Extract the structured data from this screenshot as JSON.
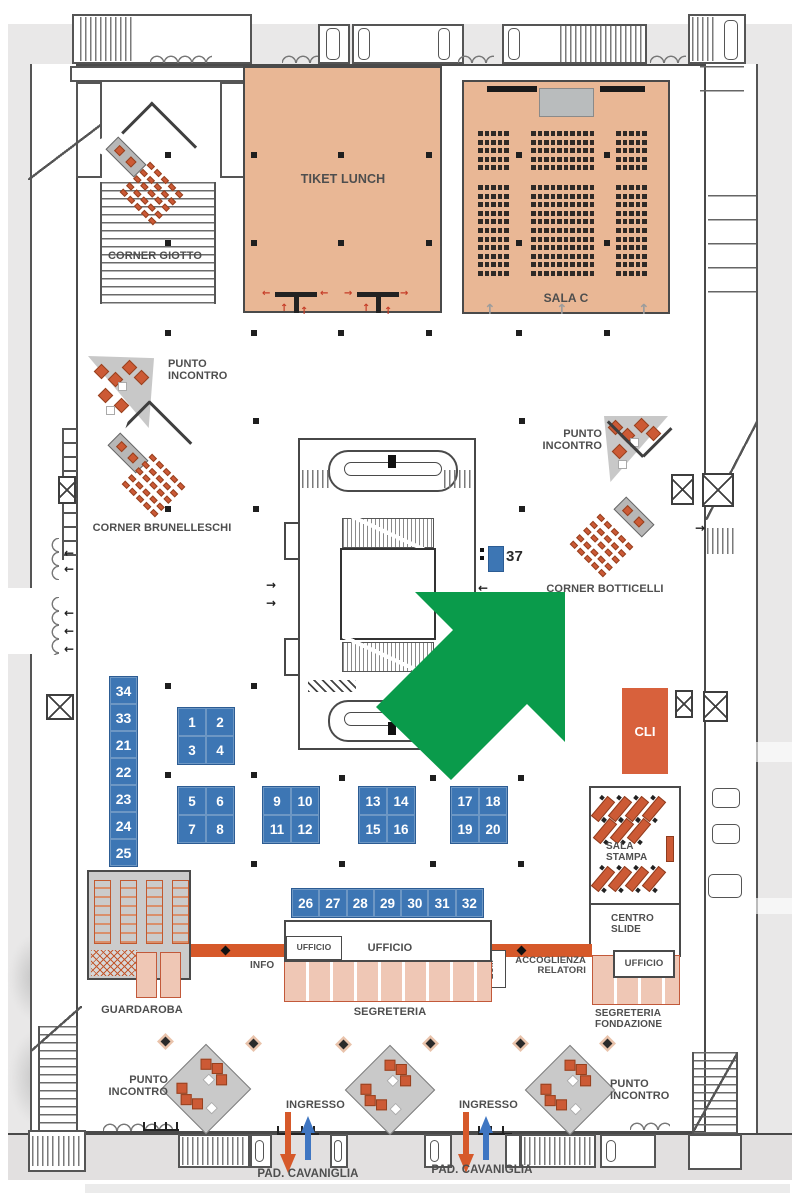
{
  "rooms": {
    "tiket_lunch": "TIKET LUNCH",
    "sala_c": "SALA C",
    "corner_giotto": "CORNER GIOTTO",
    "corner_brunelleschi": "CORNER BRUNELLESCHI",
    "corner_botticelli": "CORNER BOTTICELLI",
    "punto_incontro": "PUNTO INCONTRO",
    "cli": "CLI",
    "sala_stampa": "SALA STAMPA",
    "centro_slide": "CENTRO SLIDE",
    "ufficio": "UFFICIO",
    "info": "INFO",
    "ecm": "ECM",
    "accoglienza_relatori": "ACCOGLIENZA RELATORI",
    "segreteria": "SEGRETERIA",
    "segreteria_fondazione": "SEGRETERIA FONDAZIONE",
    "guardaroba": "GUARDAROBA",
    "ingresso": "INGRESSO",
    "pad_cavaniglia": "PAD. CAVANIGLIA"
  },
  "booths": {
    "column": [
      "34",
      "33",
      "21",
      "22",
      "23",
      "24",
      "25"
    ],
    "group_a": [
      "1",
      "2",
      "3",
      "4"
    ],
    "group_b": [
      "5",
      "6",
      "7",
      "8"
    ],
    "group_c": [
      "9",
      "10",
      "11",
      "12"
    ],
    "group_d": [
      "13",
      "14",
      "15",
      "16"
    ],
    "group_e": [
      "17",
      "18",
      "19",
      "20"
    ],
    "row": [
      "26",
      "27",
      "28",
      "29",
      "30",
      "31",
      "32"
    ],
    "single": "37"
  },
  "colors": {
    "highlight_arrow": "#0a9b4b",
    "booth_blue": "#3d76b4",
    "room_peach": "#e9b795",
    "accent_orange": "#d8613c",
    "corridor_orange": "#d6592a",
    "desk_pink": "#efc7b5",
    "floor_gray": "#e9e8e8"
  }
}
